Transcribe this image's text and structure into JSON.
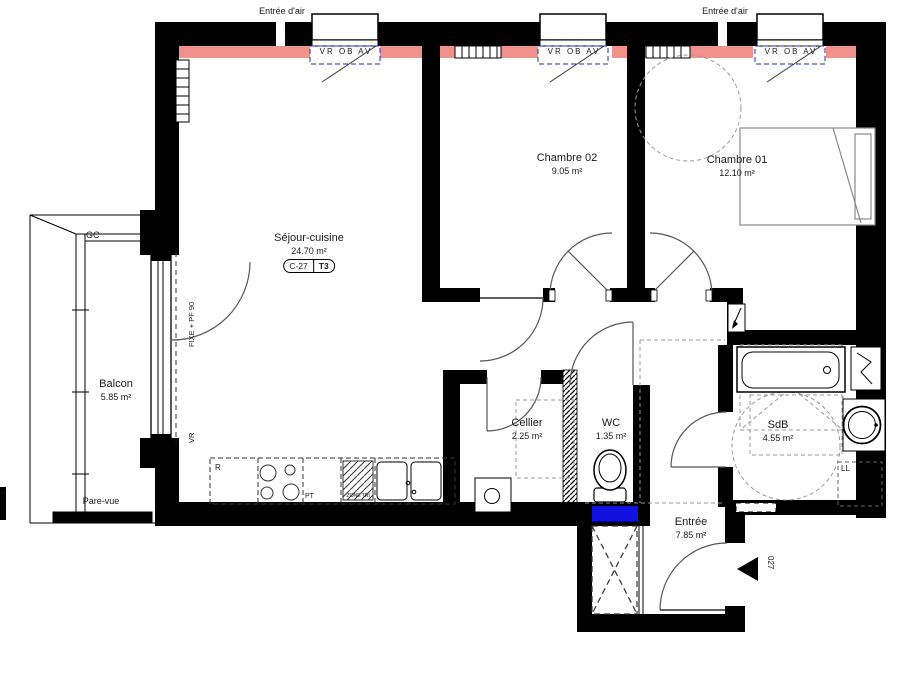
{
  "title": "Plan appartement C-27 T3",
  "unit": {
    "code": "C-27",
    "type": "T3"
  },
  "rooms": {
    "sejour": {
      "name": "Séjour-cuisine",
      "area": "24.70 m²"
    },
    "chambre02": {
      "name": "Chambre 02",
      "area": "9.05 m²"
    },
    "chambre01": {
      "name": "Chambre 01",
      "area": "12.10 m²"
    },
    "balcon": {
      "name": "Balcon",
      "area": "5.85 m²"
    },
    "cellier": {
      "name": "Cellier",
      "area": "2.25 m²"
    },
    "wc": {
      "name": "WC",
      "area": "1.35 m²"
    },
    "sdb": {
      "name": "SdB",
      "area": "4.55 m²"
    },
    "entree": {
      "name": "Entrée",
      "area": "7.85 m²"
    }
  },
  "labels": {
    "air_inlet": "Entrée d'air",
    "window": "VR OB AV",
    "gc": "GC",
    "pare_vue": "Pare-vue",
    "fixed_door": "FIXE + PF 90",
    "vr": "VR",
    "ll": "LL",
    "fridge": "R",
    "pt": "PT",
    "zone_tri": "ZONE TRI",
    "door_number": "027",
    "edge": "e"
  },
  "colors": {
    "wall": "#000000",
    "heater": "#f0918c",
    "window_box": "#2a2ab8",
    "shaft": "#1212e0",
    "arc": "#555555",
    "dashed": "#999999",
    "fixture": "#888888"
  }
}
